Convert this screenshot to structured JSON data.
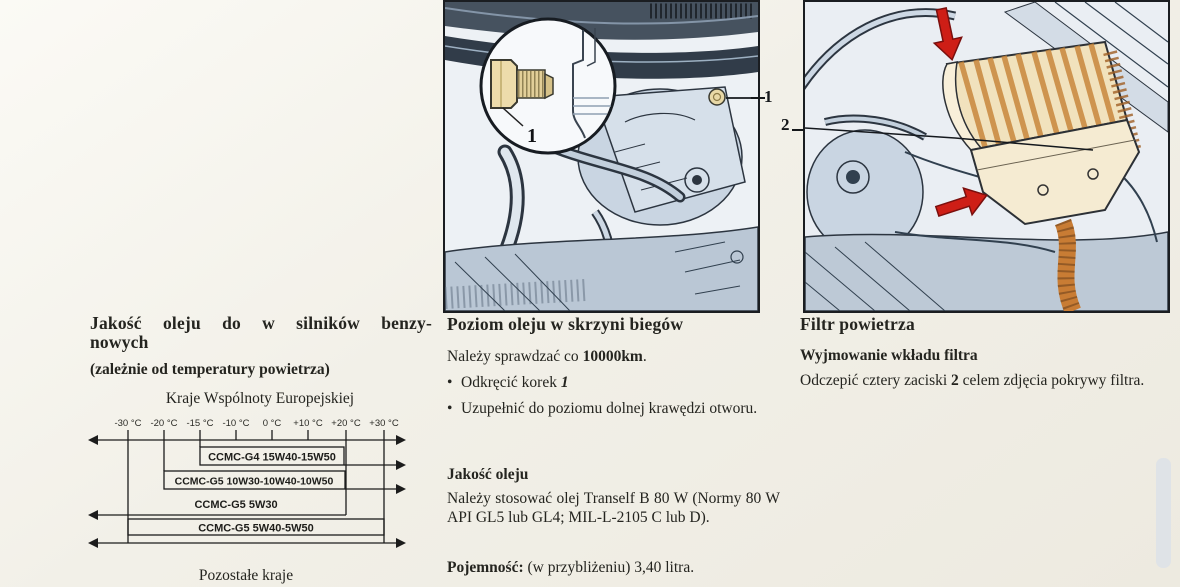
{
  "document": {
    "kind": "car owner's manual page (Polish)",
    "language": "pl"
  },
  "colors": {
    "paper": "#f2f0e8",
    "ink": "#24241f",
    "line_art": "#2c3540",
    "art_fill": "#cdd8e4",
    "filter_tan": "#f1e2bd",
    "filter_orange": "#c8873c",
    "arrow_red": "#ce1e16",
    "page_tab_gray": "#dfe3e7"
  },
  "figures": {
    "gearbox": {
      "callout_label": "1",
      "inset_label": "1"
    },
    "air_filter": {
      "callout_label": "2"
    }
  },
  "left_column": {
    "heading_line1": "Jakość oleju do w silników benzy-",
    "heading_line2": "nowych",
    "subheading": "(zależnie od temperatury powietrza)",
    "region_label": "Kraje Wspólnoty Europejskiej"
  },
  "chart_data": {
    "type": "range-bar",
    "title": "Kraje Wspólnoty Europejskiej",
    "categories": [
      "-30 °C",
      "-20 °C",
      "-15 °C",
      "-10 °C",
      "0 °C",
      "+10 °C",
      "+20 °C",
      "+30 °C"
    ],
    "rows": [
      {
        "label": "CCMC-G4 15W40-15W50",
        "range_from": "-15 °C",
        "range_to": "+30 °C",
        "open_left": false,
        "open_right": true
      },
      {
        "label": "CCMC-G5 10W30-10W40-10W50",
        "range_from": "-20 °C",
        "range_to": "+30 °C",
        "open_left": false,
        "open_right": true
      },
      {
        "label": "CCMC-G5 5W30",
        "range_from": "-30 °C",
        "range_to": "+20 °C",
        "open_left": true,
        "open_right": false
      },
      {
        "label": "CCMC-G5 5W40-5W50",
        "range_from": "-30 °C",
        "range_to": "+30 °C",
        "open_left": true,
        "open_right": true
      }
    ],
    "footnote": "Pozostałe kraje",
    "legend_position": "none",
    "grid": false
  },
  "middle_column": {
    "heading": "Poziom oleju w skrzyni biegów",
    "interval_pre": "Należy sprawdzać co ",
    "interval_bold": "10000km",
    "interval_post": ".",
    "bullet_glyph": "•",
    "bullet1_pre": "Odkręcić korek ",
    "bullet1_ref": "1",
    "bullet2": "Uzupełnić do poziomu dolnej krawędzi otworu.",
    "quality_heading": "Jakość oleju",
    "quality_body": "Należy stosować olej Tranself B 80 W (Normy 80 W API GL5 lub GL4; MIL-L-2105 C lub D).",
    "capacity_label": "Pojemność:",
    "capacity_text": " (w przybliżeniu) 3,40 litra."
  },
  "right_column": {
    "heading": "Filtr powietrza",
    "subheading": "Wyjmowanie wkładu filtra",
    "body_pre": "Odczepić cztery zaciski ",
    "body_ref": "2",
    "body_post": " celem zdjęcia pokrywy filtra."
  }
}
